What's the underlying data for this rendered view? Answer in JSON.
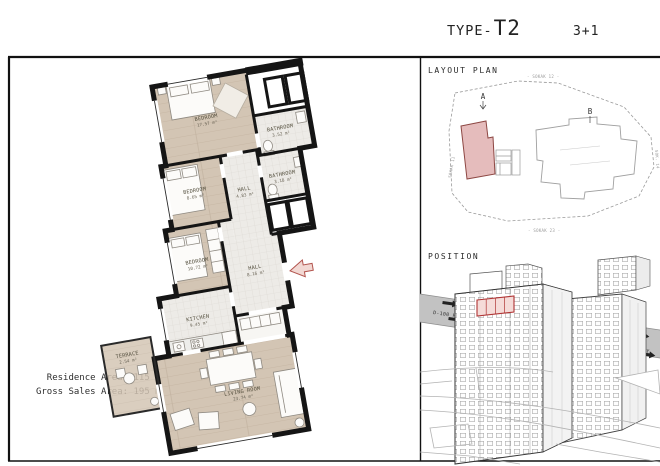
{
  "header": {
    "type_prefix": "TYPE-",
    "type_code": "T2",
    "plan_config": "3+1"
  },
  "floor_plan": {
    "rooms": [
      {
        "name": "BEDROOM",
        "area": "17.57 m²"
      },
      {
        "name": "BATHROOM",
        "area": "3.52 m²"
      },
      {
        "name": "BEDROOM",
        "area": "8.65 m²"
      },
      {
        "name": "HALL",
        "area": "4.83 m²"
      },
      {
        "name": "BATHROOM",
        "area": "3.18 m²"
      },
      {
        "name": "BEDROOM",
        "area": "10.72 m²"
      },
      {
        "name": "HALL",
        "area": "8.16 m²"
      },
      {
        "name": "KITCHEN",
        "area": "9.45 m²"
      },
      {
        "name": "TERRACE",
        "area": "2.54 m²"
      },
      {
        "name": "LIVING ROOM",
        "area": "23.74 m²"
      }
    ],
    "summary": {
      "residence": "Residence Area: 115 m²",
      "gross_sales": "Gross Sales Area: 195 m²"
    }
  },
  "layout_plan": {
    "title": "LAYOUT PLAN",
    "block_a": "A",
    "block_b": "B",
    "streets": {
      "top": "- SOKAK 12 -",
      "bottom": "- SOKAK 23 -",
      "left": "SOKAK 11",
      "right": "SOK. 14"
    }
  },
  "position": {
    "title": "POSITION",
    "highway_left": "D-100 HIGHWAY",
    "highway_right": "D-100 HIGHWAY"
  },
  "colors": {
    "wall": "#151515",
    "wood": "#d3c5b4",
    "wood_line": "#c3b3a0",
    "tile": "#edebe7",
    "tile_line": "#dbd8d2",
    "block_pink": "#e5bcbc",
    "block_pink_border": "#8d4743",
    "unit_red": "#b03434",
    "unit_fill": "#f5dbd8",
    "highway_gray": "#c2c2c2",
    "line_gray": "#9a9a9a",
    "entrance_arrow": "#b2544e"
  }
}
